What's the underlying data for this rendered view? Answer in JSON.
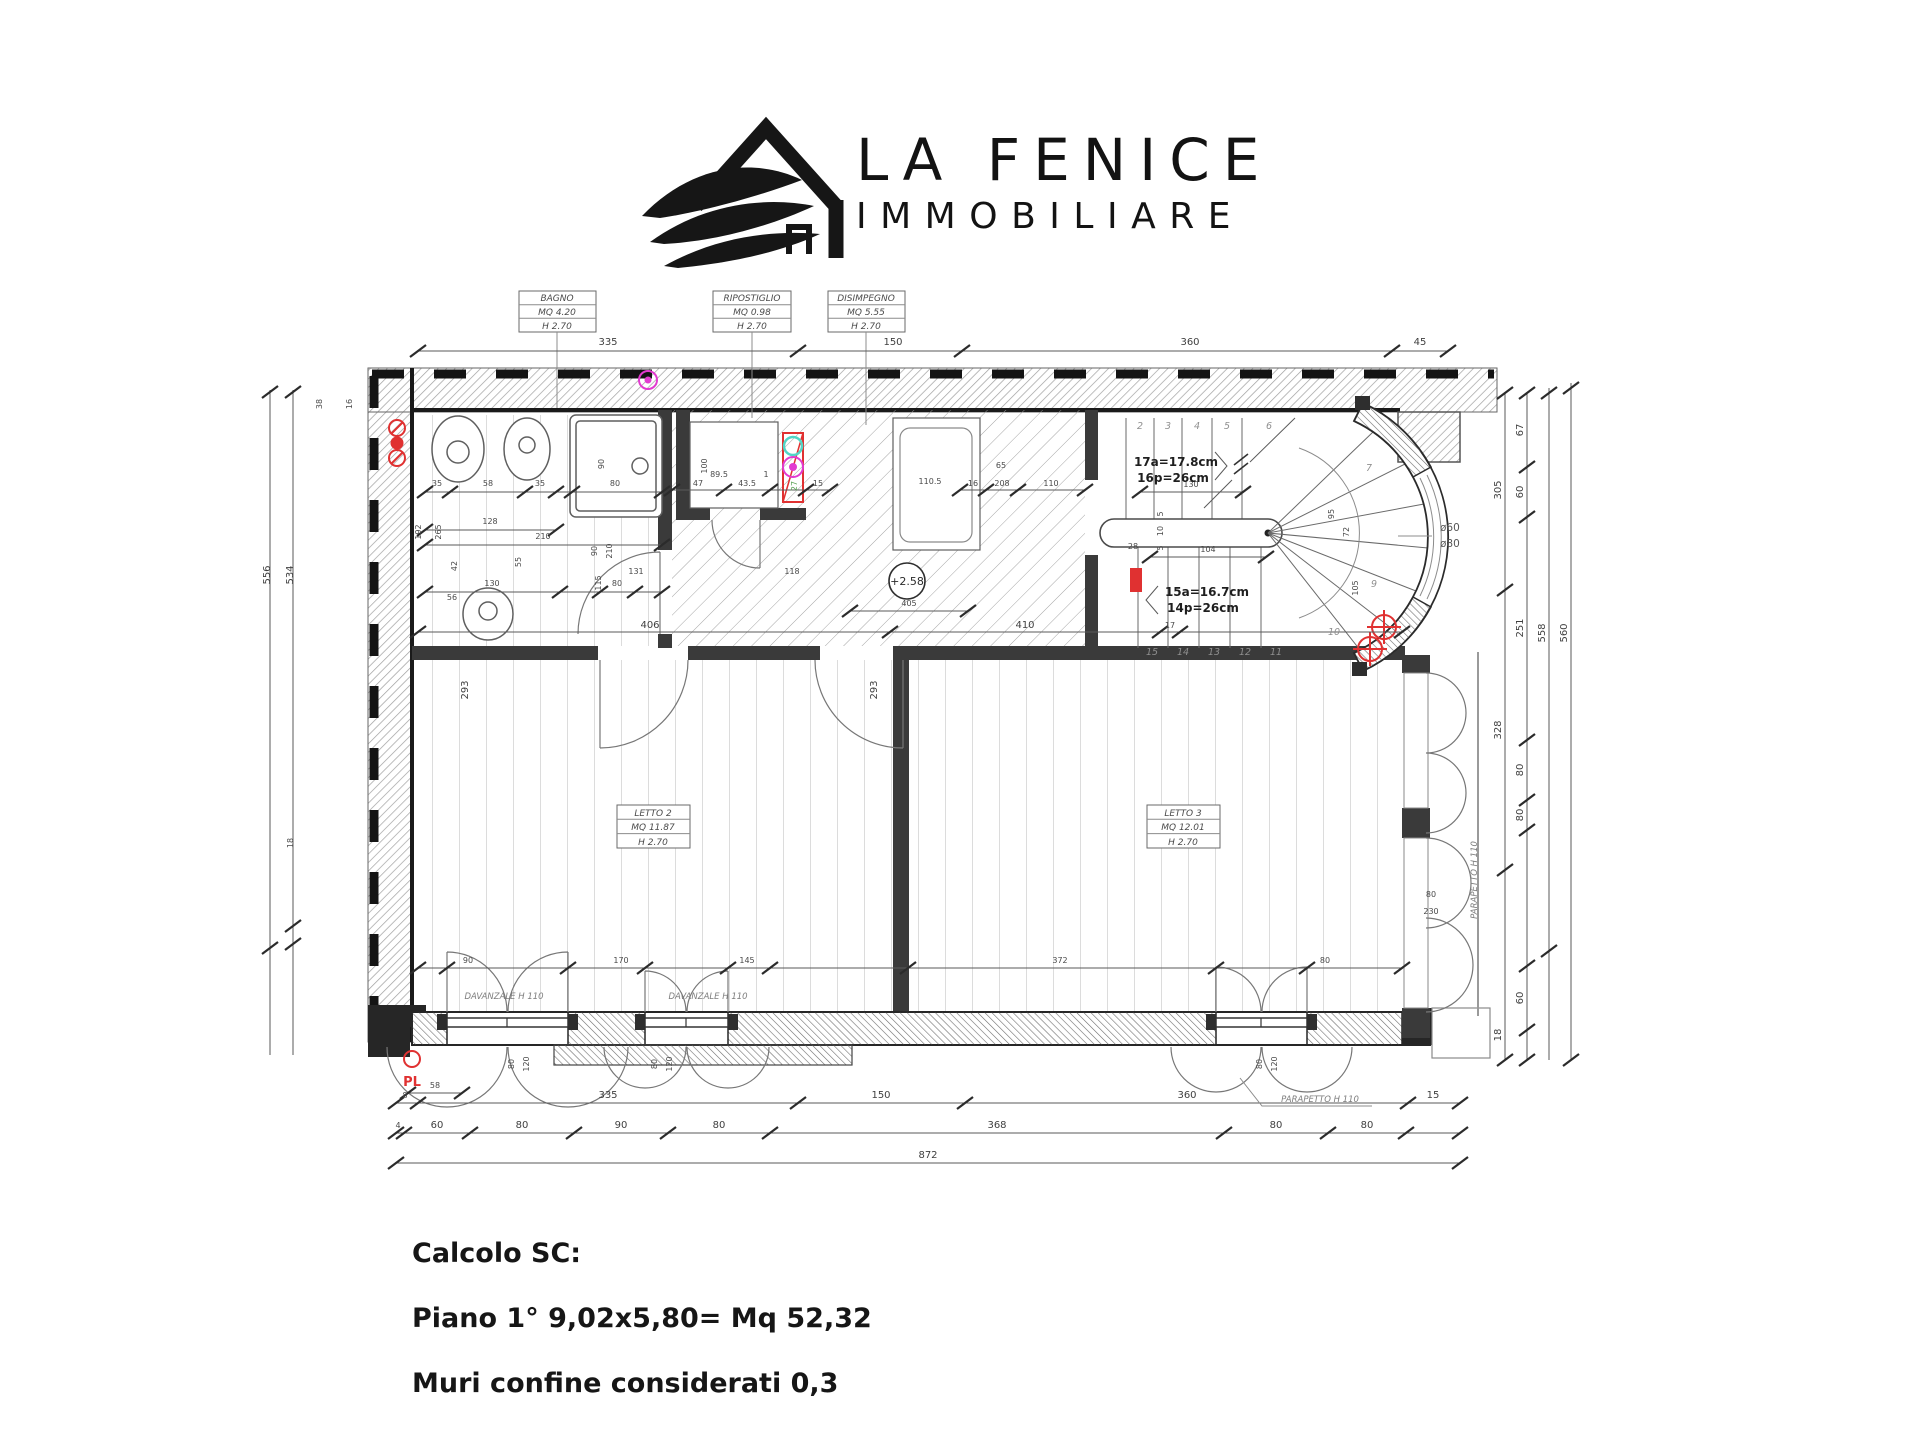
{
  "logo": {
    "line1": "LA FENICE",
    "line2": "IMMOBILIARE"
  },
  "footer": {
    "title": "Calcolo SC:",
    "line1": "Piano 1° 9,02x5,80= Mq 52,32",
    "line2": "Muri confine considerati 0,3"
  },
  "boxes": {
    "bagno": [
      "BAGNO",
      "MQ 4.20",
      "H 2.70"
    ],
    "ripostiglio": [
      "RIPOSTIGLIO",
      "MQ 0.98",
      "H 2.70"
    ],
    "disimpegno": [
      "DISIMPEGNO",
      "MQ 5.55",
      "H 2.70"
    ],
    "letto2": [
      "LETTO 2",
      "MQ 11.87",
      "H 2.70"
    ],
    "letto3": [
      "LETTO 3",
      "MQ 12.01",
      "H 2.70"
    ]
  },
  "notes": {
    "a17": "17a=17.8cm",
    "p16": "16p=26cm",
    "a15": "15a=16.7cm",
    "p14": "14p=26cm",
    "davanzale1": "DAVANZALE H 110",
    "davanzale2": "DAVANZALE H 110",
    "parapetto1": "PARAPETTO H 110",
    "parapetto2": "PARAPETTO H 110",
    "d60": "ø60",
    "d80": "ø80",
    "level": "+2.58",
    "pl": "PL"
  },
  "dim": {
    "top": [
      "335",
      "150",
      "360",
      "45"
    ],
    "b1": [
      "8",
      "335",
      "150",
      "360",
      "15"
    ],
    "b2": [
      "4",
      "60",
      "80",
      "90",
      "80",
      "368",
      "80",
      "80"
    ],
    "b3": [
      "872"
    ],
    "b58": "58",
    "r1": [
      "305",
      "328",
      "18"
    ],
    "r2": [
      "67",
      "60",
      "251",
      "80",
      "80",
      "60"
    ],
    "r3": "558",
    "r4": "560",
    "left": [
      "38",
      "16",
      "556",
      "534",
      "18"
    ],
    "bath": [
      "35",
      "58",
      "35",
      "80",
      "90",
      "128",
      "210",
      "192",
      "265",
      "130",
      "115",
      "80",
      "56",
      "55",
      "42"
    ],
    "mid": [
      "47",
      "43.5",
      "100",
      "89.5",
      "1",
      "27",
      "15",
      "110.5",
      "65",
      "16",
      "208",
      "110",
      "405"
    ],
    "rooms": [
      "406",
      "410",
      "17",
      "293",
      "293",
      "131",
      "118",
      "90",
      "210"
    ],
    "win": [
      "90",
      "170",
      "145",
      "372",
      "80"
    ],
    "winv": [
      "80",
      "120",
      "80",
      "120",
      "80",
      "120"
    ],
    "stair": [
      "130",
      "104",
      "28",
      "95",
      "72",
      "105",
      "5",
      "10",
      "5",
      "80",
      "230"
    ],
    "steps": [
      "2",
      "3",
      "4",
      "5",
      "6",
      "7",
      "9",
      "10",
      "11",
      "12",
      "13",
      "14",
      "15"
    ]
  },
  "colors": {
    "red": "#e03131",
    "magenta": "#e23bd0",
    "cyan": "#52d5c6",
    "green": "#57a052",
    "wall": "#2b2b2b",
    "line": "#5a5a5a"
  }
}
